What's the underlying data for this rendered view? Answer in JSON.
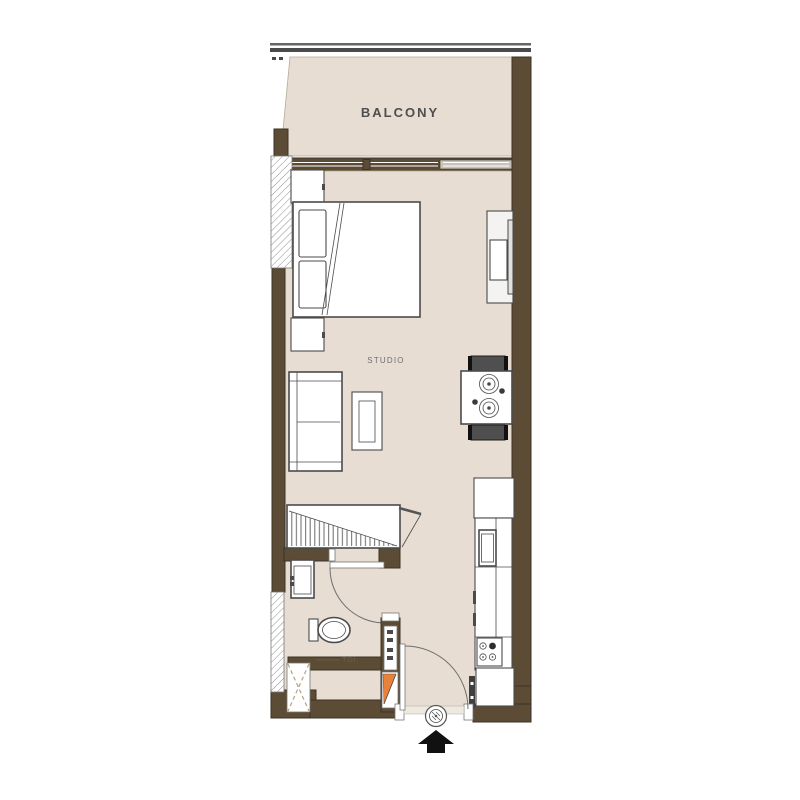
{
  "plan": {
    "type": "studio-apartment-floor-plan",
    "labels": {
      "balcony": "BALCONY",
      "studio": "STUDIO",
      "toilet": "TOI."
    }
  },
  "colors": {
    "bg": "#ffffff",
    "floor": "#e7ddd2",
    "wall": "#5d4c35",
    "wall_dark": "#3c3227",
    "line": "#4b4b4b",
    "text": "#4e4e4e",
    "toi_text": "#6e5d4b",
    "orange": "#e8823b",
    "chair": "#4f4f4f",
    "hatch_line": "#8f8f8f",
    "shaft_dash": "#b5a284",
    "railing": "#4a4a4a",
    "window": "#c9c2b6"
  }
}
